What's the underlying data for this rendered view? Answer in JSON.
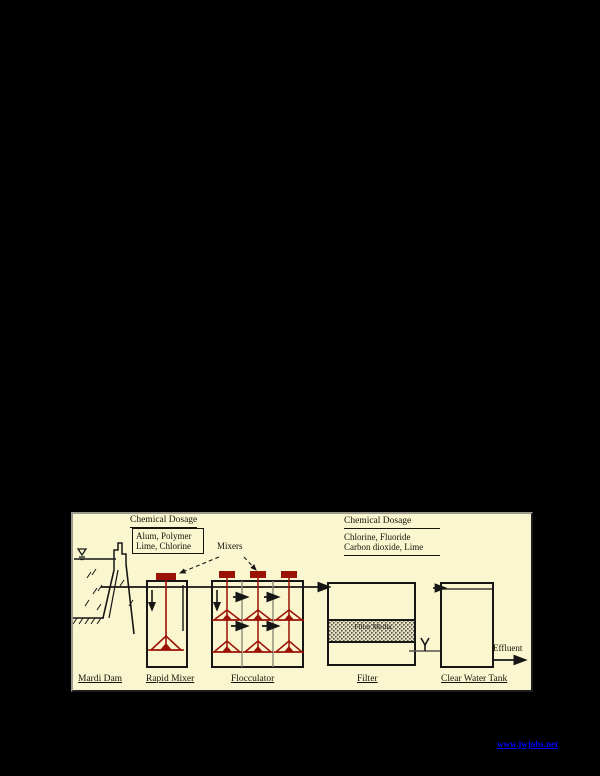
{
  "page": {
    "background_color": "#000000"
  },
  "diagram": {
    "left_dosage": {
      "heading": "Chemical Dosage",
      "items": [
        "Alum, Polymer",
        "Lime, Chlorine"
      ]
    },
    "right_dosage": {
      "heading": "Chemical Dosage",
      "items": [
        "Chlorine, Fluoride",
        "Carbon dioxide, Lime"
      ]
    },
    "mixers_label": "Mixers",
    "filter_media_label": "Filter Media",
    "effluent_label": "Effluent",
    "stage_labels": {
      "dam": "Mardi Dam",
      "rapid_mixer": "Rapid Mixer",
      "flocculator": "Flocculator",
      "filter": "Filter",
      "clear_water_tank": "Clear Water Tank"
    },
    "colors": {
      "diagram_background": "#FAF6CF",
      "mixer": "#9B1206",
      "line": "#161616",
      "cell_divider": "#8a8a78"
    }
  },
  "footer": {
    "link": "www.jwjobs.net",
    "link_color": "#0000FF"
  }
}
